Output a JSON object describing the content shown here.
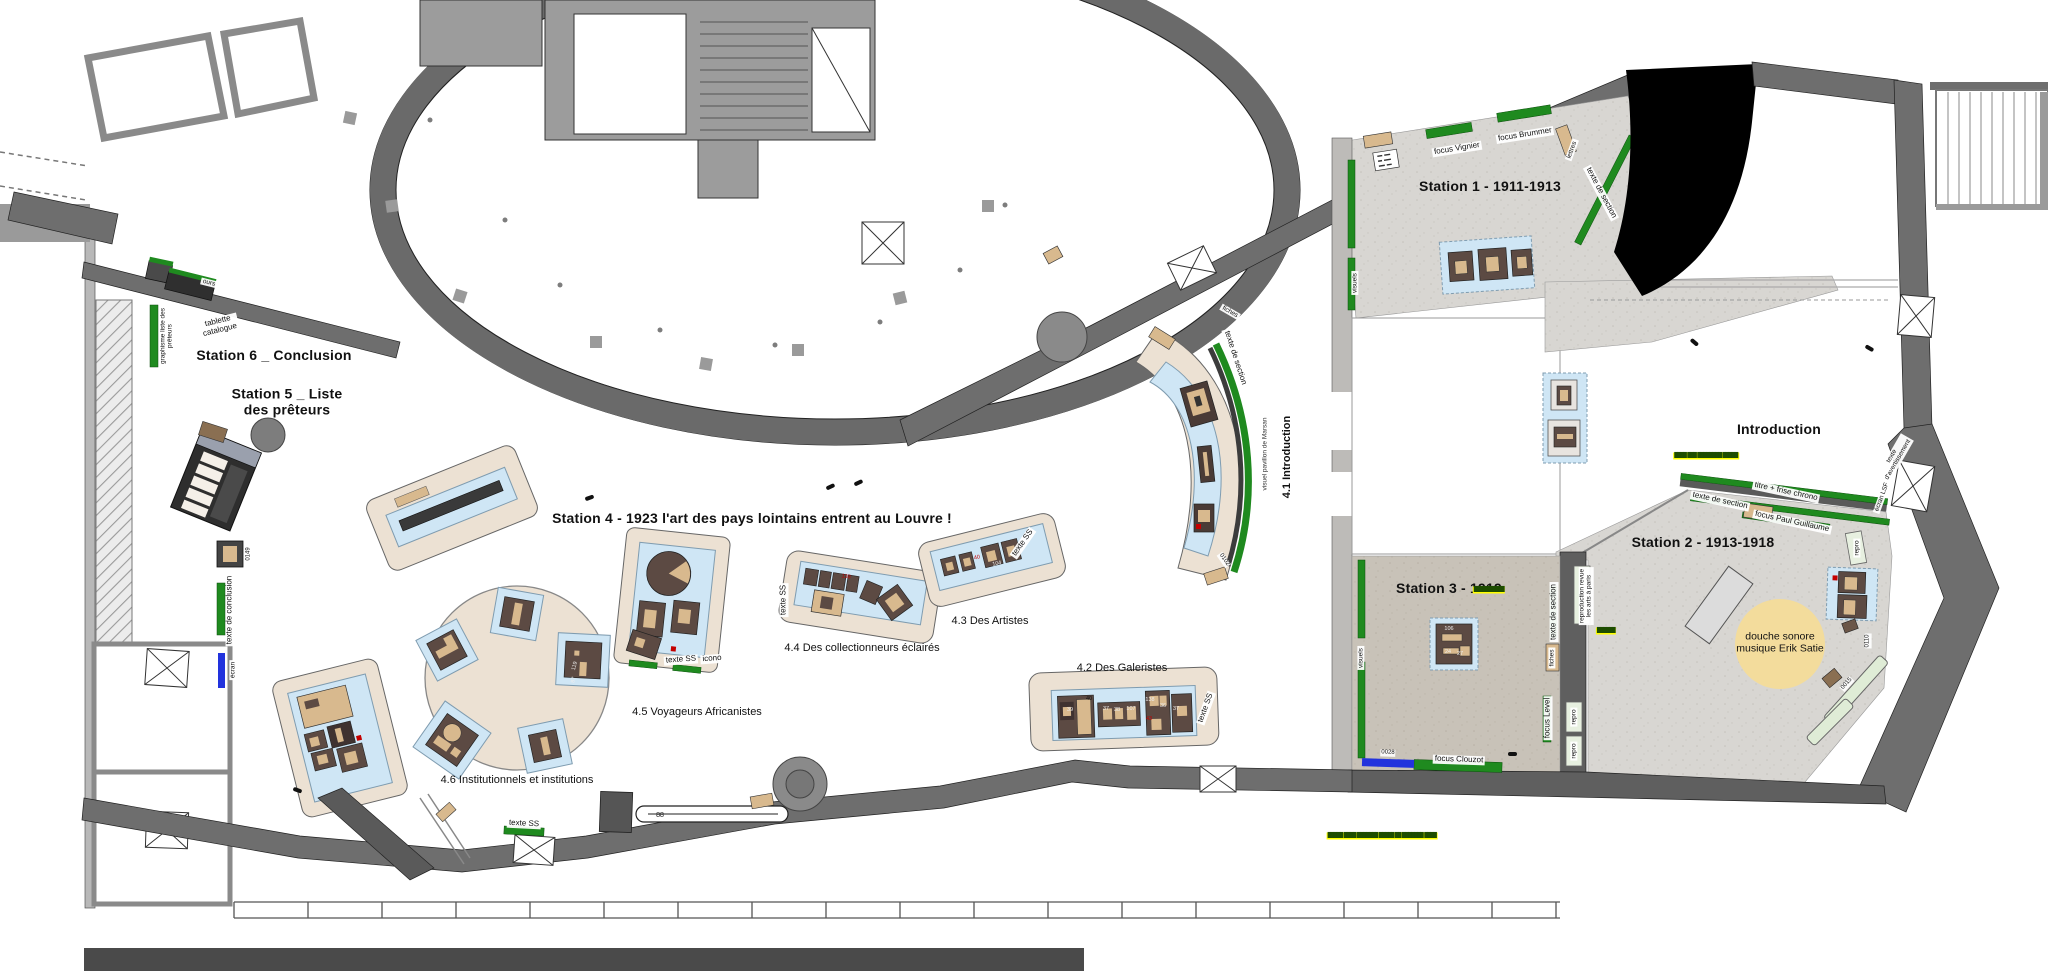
{
  "stations": {
    "s1": "Station 1 - 1911-1913",
    "s2": "Station 2 - 1913-1918",
    "s3": "Station 3 - 1919",
    "s4": "Station 4 - 1923 l'art des pays lointains entrent au Louvre !",
    "s5": "Station 5 _ Liste\ndes prêteurs",
    "s6": "Station 6 _ Conclusion",
    "intro": "Introduction"
  },
  "areas": {
    "a41": "4.1 Introduction",
    "a42": "4.2 Des Galeristes",
    "a43": "4.3 Des Artistes",
    "a44": "4.4 Des collectionneurs éclairés",
    "a45": "4.5 Voyageurs Africanistes",
    "a46": "4.6 Institutionnels et institutions"
  },
  "features": {
    "douche": "douche sonore\nmusique Erik Satie"
  },
  "wall_labels": {
    "focus_vignier": "focus Vignier",
    "focus_brummer": "focus Brummer",
    "focus_paul_guillaume": "focus Paul Guillaume",
    "focus_level": "focus Level",
    "focus_clouzot": "focus Clouzot",
    "texte_de_section": "texte de section",
    "texte_de_conclusion": "texte de conclusion",
    "titre_frise_chrono": "titre + frise chrono",
    "texte_avertissement": "texte\nd'avertissement",
    "ecran_lsf": "écran LSF",
    "ecran": "écran",
    "visuels": "visuels",
    "visuel_pavillon": "visuel pavillon de Marsan",
    "fiches": "fiches",
    "lettres": "lettres",
    "ours": "ours",
    "tablette_catalogue": "tablette\ncatalogue",
    "graphisme_liste": "graphisme liste des\nprêteurs",
    "reproduction_revue": "reproduction  revue\nles arts à paris",
    "repro": "repro",
    "texte_ss": "texte SS",
    "icono": "icono"
  },
  "numbers": {
    "n88": "88",
    "n0028": "0028",
    "n0102": "0102",
    "n0110": "0110",
    "n0015": "0015",
    "n0149": "0149",
    "n106": "106",
    "n24": "24",
    "n27": "27",
    "n39": "39",
    "n40": "40",
    "n37": "37",
    "n38": "38",
    "n107": "107",
    "n138": "138",
    "n36": "36",
    "n43": "43",
    "n104": "104",
    "n119": "119",
    "n87": "87"
  },
  "notes": {
    "highlight_intro": "████ ███ ████████ █████",
    "highlight_plinth": "█████ ████ ███████ █████ ██ ███████ ████",
    "highlight_station3": "██████████",
    "highlight_small": "██████"
  },
  "colors": {
    "wall_dark": "#6e6e6e",
    "wall_light": "#b9b7b4",
    "floor_grey": "#d8d6d2",
    "floor_warm": "#c8c2b8",
    "platform_beige": "#ece1d3",
    "case_blue": "#cfe6f5",
    "artifact_brown": "#5c4a43",
    "artifact_tan": "#d8b98e",
    "strip_green": "#1f8a1f",
    "strip_blue": "#2233dd",
    "bench_green": "#dfecd6",
    "sound_circle": "#f3dc9c",
    "highlight_yellow": "#ffff00",
    "void_black": "#000000"
  }
}
